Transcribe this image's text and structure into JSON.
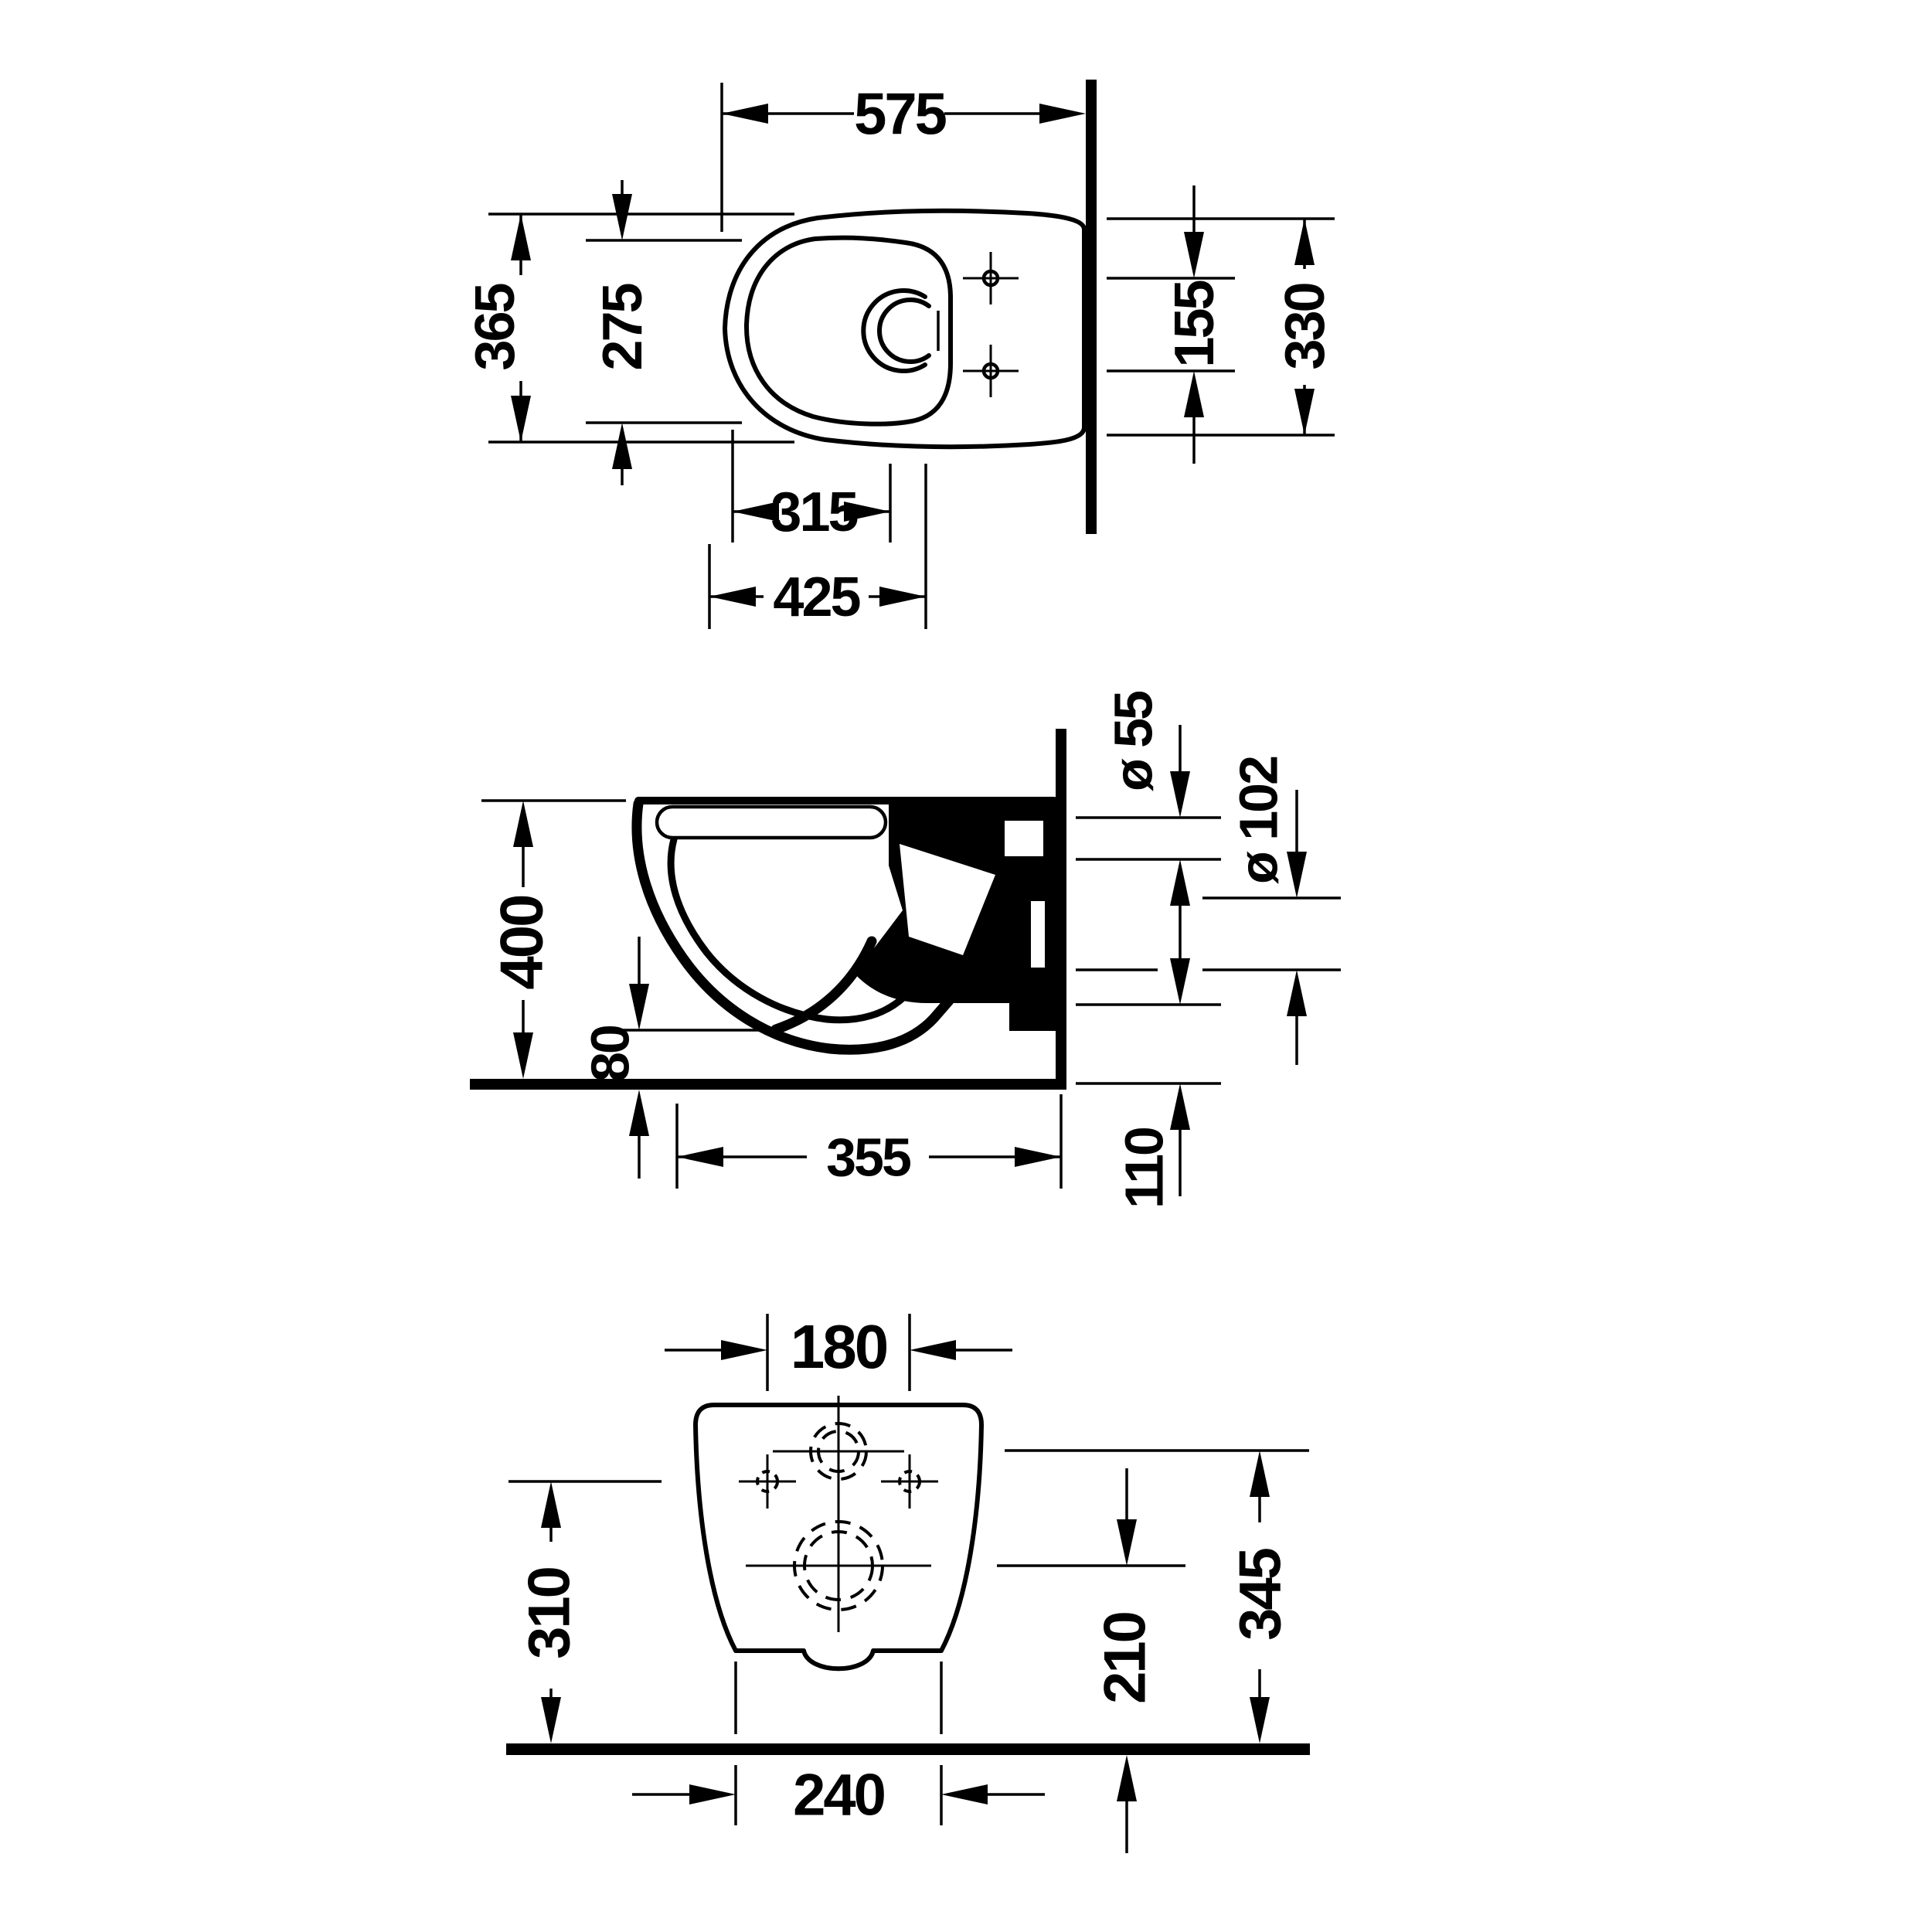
{
  "labels": {
    "top": {
      "overall_depth": "575",
      "overall_width": "365",
      "bowl_inner_width": "275",
      "hole_offset": "155",
      "hole_span": "330",
      "dist_315": "315",
      "dist_425": "425"
    },
    "side": {
      "height_400": "400",
      "clearance_80": "80",
      "depth_355": "355",
      "outlet_height_110": "110",
      "flush_pipe_dia": "ø 55",
      "outlet_pipe_dia": "ø 102"
    },
    "rear": {
      "hole_spacing_180": "180",
      "hole_height_310": "310",
      "base_width_240": "240",
      "outlet_height_210": "210",
      "flush_height_345": "345"
    }
  },
  "colors": {
    "ink": "#000000",
    "paper": "#ffffff"
  }
}
